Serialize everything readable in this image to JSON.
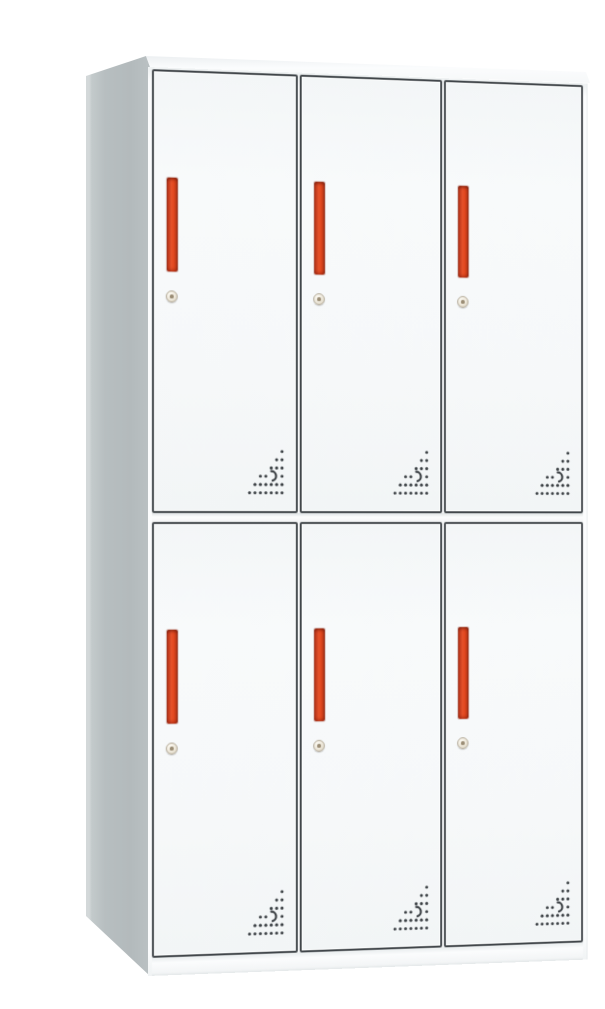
{
  "image": {
    "kind": "product photo",
    "subject": "6-door steel locker cabinet, 2 rows by 3 columns",
    "background": "plain white studio background",
    "caption": "White metal storage locker with six doors; each door has a vertical red recessed pull handle, a round key lock below the handle, and a triangular pattern of perforated ventilation holes in its lower-right corner."
  },
  "cabinet": {
    "rows": 2,
    "columns": 3,
    "door_count": 6,
    "features": {
      "handle": "vertical red recessed pull handle",
      "lock": "round key lock below handle",
      "vents": "triangular perforation pattern at lower-right of each door",
      "base": "white plinth base",
      "side": "grey left side panel seen in perspective"
    }
  },
  "colors": {
    "background": "#ffffff",
    "body_white": "#fbfcfd",
    "door_face": "#f6f8f9",
    "door_border": "#41464a",
    "side_panel": "#b7bec0",
    "side_panel_edge": "#d3d8d9",
    "top_face": "#f4f6f7",
    "handle_red": "#e4512a",
    "handle_red_dark": "#9c2d18",
    "keyhole_face": "#ece6d8",
    "keyhole_ring": "#b4ab99",
    "vent_dot": "#3b4044"
  }
}
